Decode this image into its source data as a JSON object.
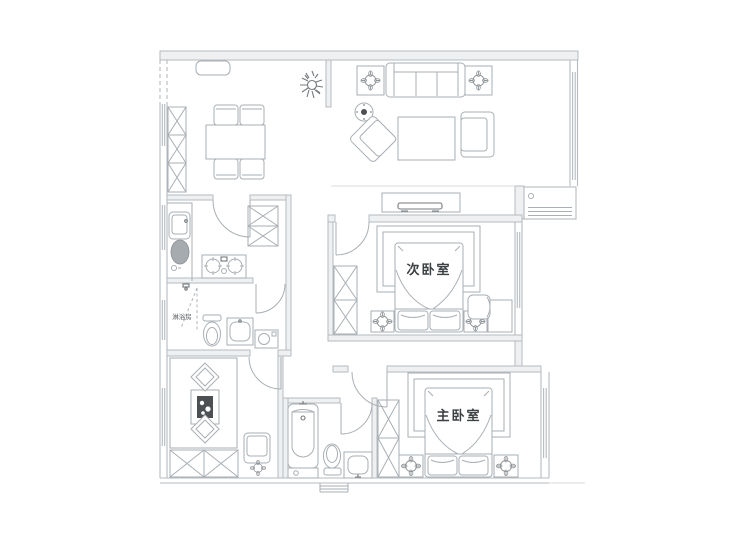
{
  "floor_plan": {
    "kind": "residential-apartment-floor-plan",
    "labels": {
      "secondary_bedroom": "次卧室",
      "master_bedroom": "主卧室",
      "shower_room": "淋浴房"
    },
    "colors": {
      "background": "#ffffff",
      "wall_line": "#b6bbc0",
      "wall_fill": "#eef0f1",
      "furniture_line": "#a9afb4",
      "dark_accent": "#4c5053",
      "label_text": "#3c4043"
    }
  }
}
